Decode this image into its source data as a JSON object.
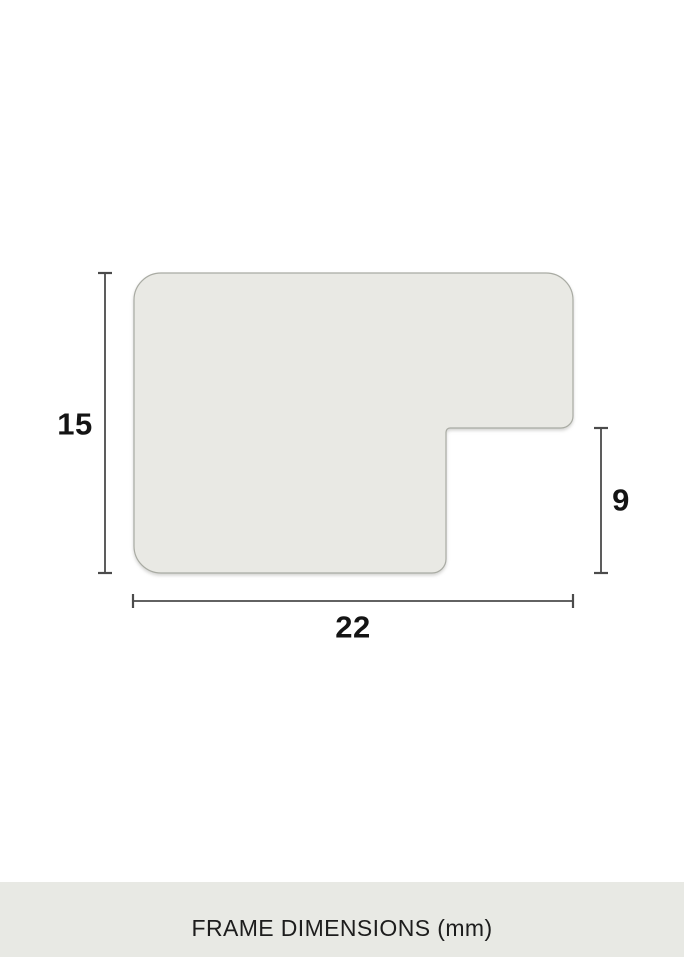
{
  "diagram": {
    "dimensions": {
      "height": {
        "label": "15",
        "value_mm": 15,
        "orientation": "vertical",
        "side": "left"
      },
      "rabbet": {
        "label": "9",
        "value_mm": 9,
        "orientation": "vertical",
        "side": "right"
      },
      "width": {
        "label": "22",
        "value_mm": 22,
        "orientation": "horizontal",
        "side": "bottom"
      }
    }
  },
  "caption": {
    "label": "FRAME DIMENSIONS (mm)"
  },
  "colors": {
    "background": "#ffffff",
    "shape_fill": "#e9e9e4",
    "shape_stroke": "#a9aba3",
    "dimension_line": "#4b4b4b",
    "label_text": "#141414",
    "caption_bg": "#e8e9e4",
    "caption_text": "#1d1d1d"
  }
}
